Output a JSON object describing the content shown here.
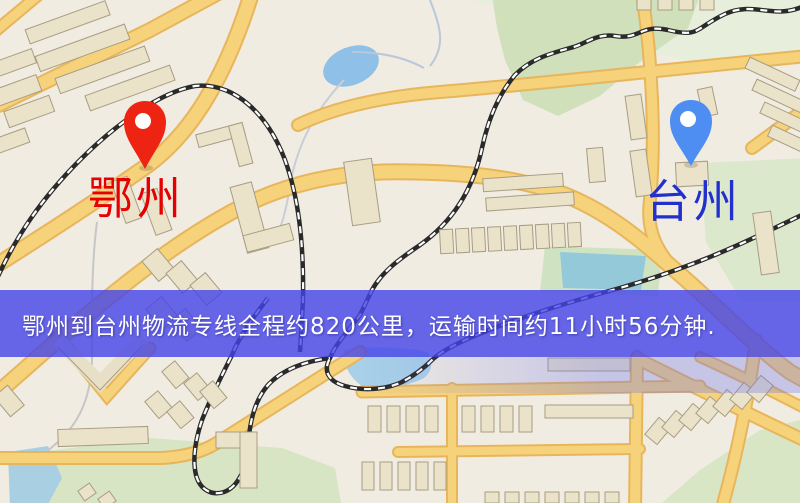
{
  "map": {
    "origin": {
      "label": "鄂州",
      "pin_color": "#ee2413",
      "label_color": "#e60000"
    },
    "destination": {
      "label": "台州",
      "pin_color": "#4e8df2",
      "label_color": "#2230cc"
    },
    "banner": {
      "text": "鄂州到台州物流专线全程约820公里，运输时间约11小时56分钟.",
      "bg_color": "#4343e8",
      "text_color": "#ffffff"
    },
    "map_colors": {
      "background": "#f0ece2",
      "road_fill": "#f6d27b",
      "road_casing": "#e7b65c",
      "water": "#8fc0e8",
      "park_green": "#cfe0bb",
      "building": "#eae2c9",
      "railway": "#2a2a2a"
    }
  }
}
